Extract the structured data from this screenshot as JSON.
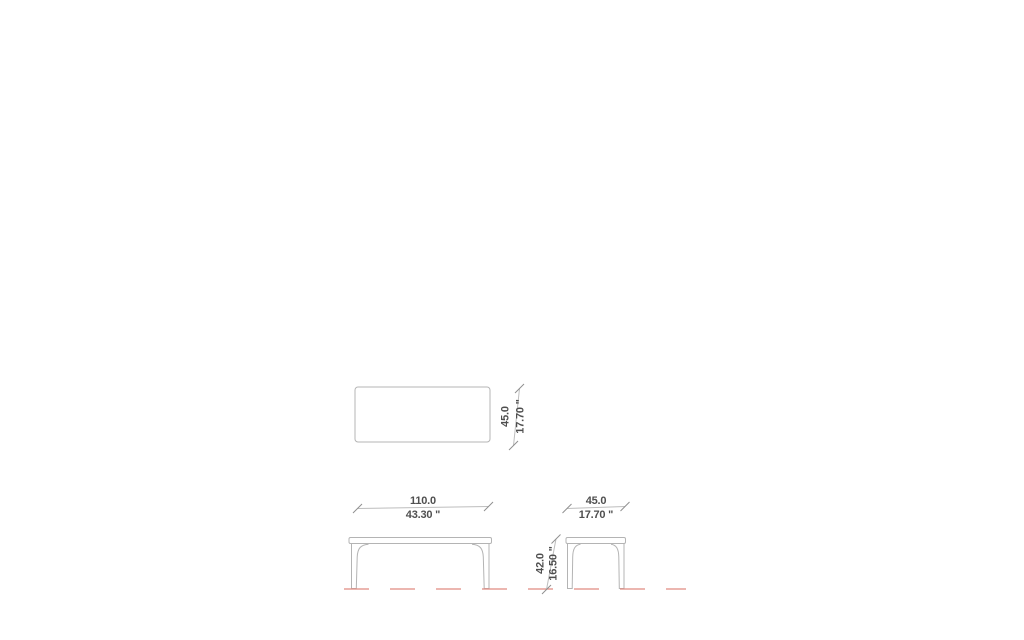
{
  "diagram": {
    "colors": {
      "bg": "#ffffff",
      "outline": "#b4b4b4",
      "dim": "#bdbdbd",
      "tick": "#8f8f8f",
      "text": "#4f4f4f",
      "floor": "#e08a80"
    },
    "dimensions": {
      "top_depth": {
        "metric": "45.0",
        "imperial": "17.70 \""
      },
      "front_width": {
        "metric": "110.0",
        "imperial": "43.30 \""
      },
      "side_depth": {
        "metric": "45.0",
        "imperial": "17.70 \""
      },
      "height": {
        "metric": "42.0",
        "imperial": "16.50 \""
      }
    }
  }
}
